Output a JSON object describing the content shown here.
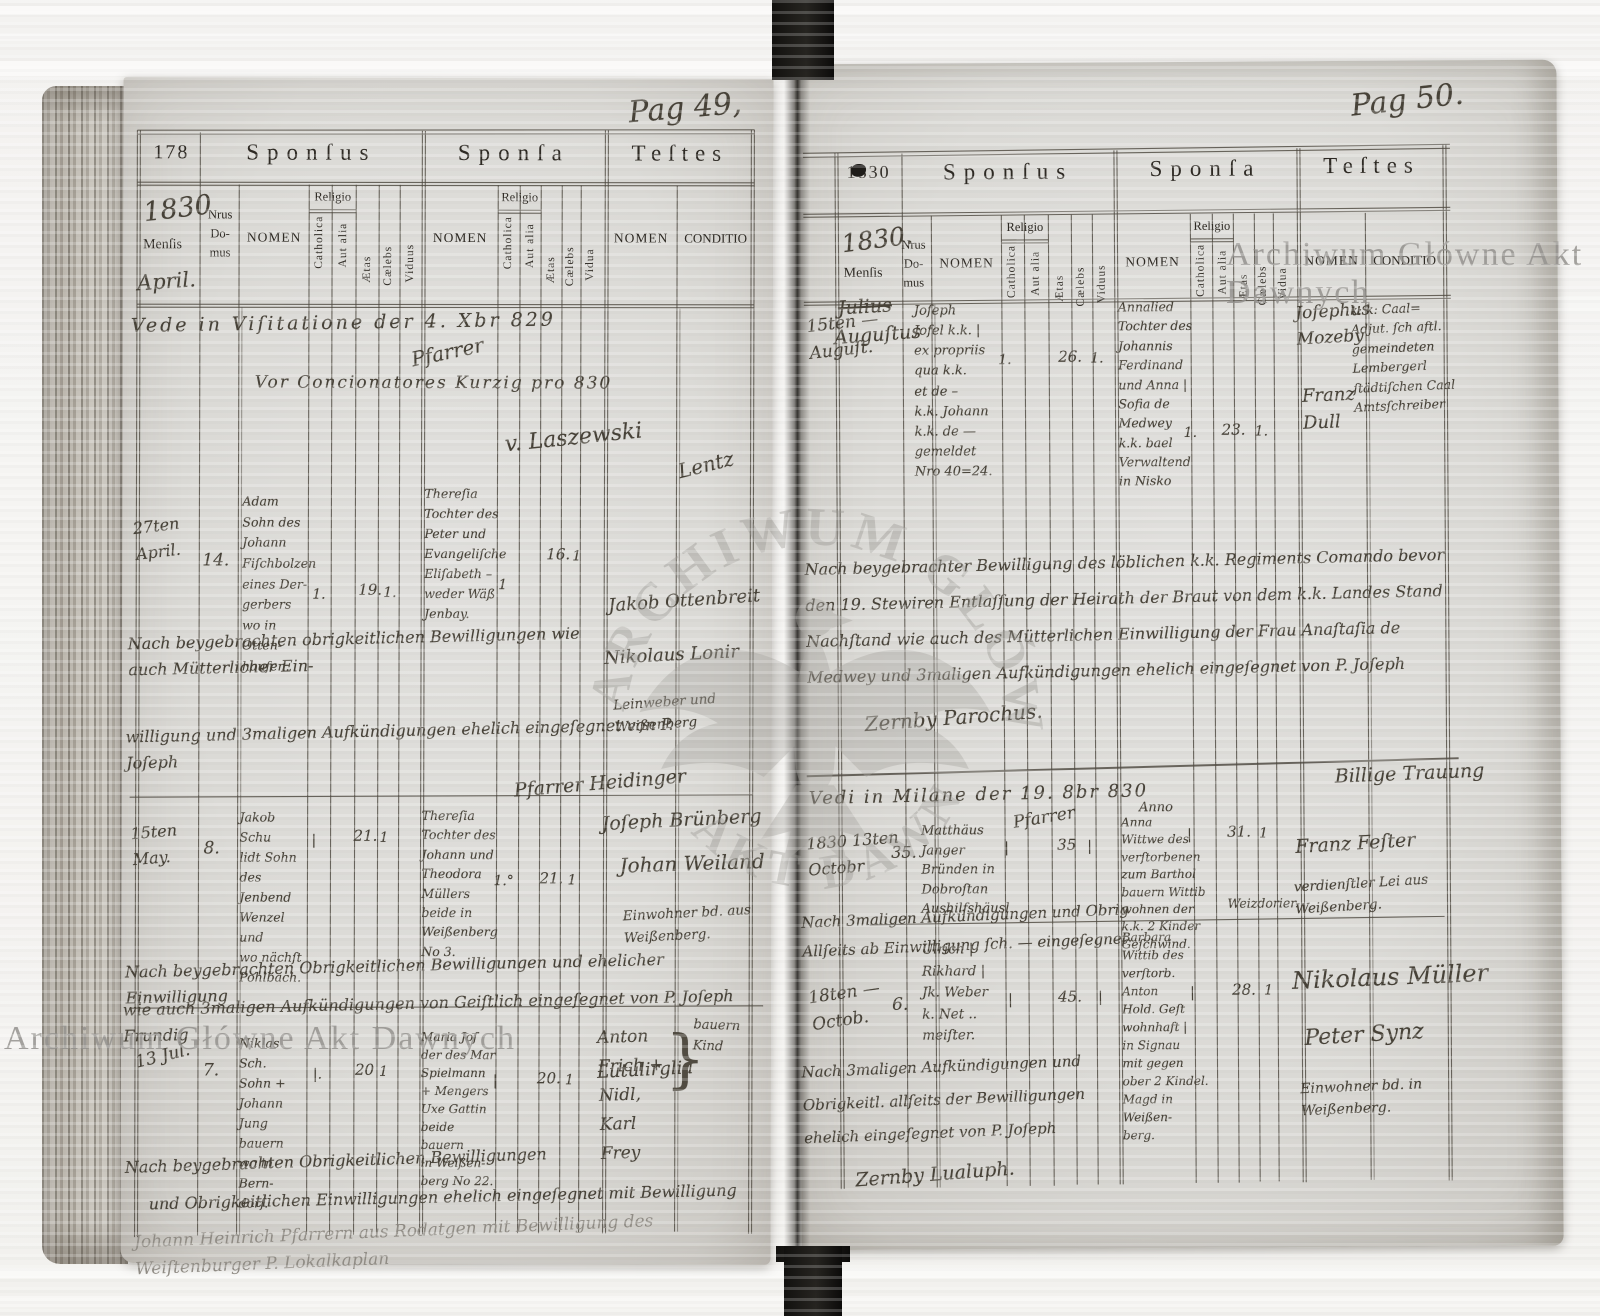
{
  "watermarks": {
    "stamp_left": "Archiwum Główne Akt Dawnych",
    "stamp_right": "Archiwum Główne Akt Dawnych",
    "seal_arc_top": "ARCHIWUM GŁÓWNE",
    "seal_arc_bottom": "AKT DAWNYCH"
  },
  "labels": {
    "sponsus": "Sponſus",
    "sponsa": "Sponſa",
    "testes": "Teſtes",
    "mensis": "Menſis",
    "nrus_domus": "Nrus\nDo-\nmus",
    "nomen": "NOMEN",
    "religio": "Religio",
    "catholica": "Catholica",
    "aut_alia": "Aut alia",
    "aetas": "Ætas",
    "caelebs": "Cælebs",
    "viduus": "Viduus",
    "vidua": "Vidua",
    "conditio": "CONDITIO"
  },
  "left_page": {
    "page_number": "Pag 49,",
    "folio": "178",
    "year": "1830",
    "month": "April.",
    "visitation": {
      "line1": "Vede in Viſitatione der 4. Xbr 829",
      "sig": "Pfarrer",
      "line2": "Vor Concionatores Kurzig pro 830",
      "line3": "v. Laszewski",
      "flourish": "Lentz"
    },
    "entries": [
      {
        "date": "27ten\nApril.",
        "nr": "14.",
        "groom": "Adam\nSohn des\nJohann\nFiſchbolzen\neines Der-\ngerbers\nwo in Otten-\nhauſen.",
        "groom_cath": "1.",
        "groom_aetas": "19.",
        "groom_cael": "1.",
        "bride": "Thereſia\nTochter des\nPeter und\nEvangeliſche\nEliſabeth –\nweder Wäß\nJenbay.",
        "bride_cath": "1",
        "bride_aetas": "16.",
        "bride_cael": "1",
        "witness1": "Jakob Ottenbreit",
        "witness2": "Nikolaus Lonir",
        "witness_note": "Leinweber und\nWeißenberg",
        "note1": "Nach beygebrachten obrigkeitlichen Bewilligungen wie auch Mütterlicher Ein-",
        "note2": "willigung und 3maligen Aufkündigungen ehelich eingeſegnet von P. Joſeph",
        "note_sig": "Pfarrer Heidinger"
      },
      {
        "date": "15ten\nMay.",
        "nr": "8.",
        "groom": "Jakob Schu\nlidt Sohn des\nJenbend\nWenzel und\nwo nächſt\nPohlbach.",
        "groom_cath": "|",
        "groom_aetas": "21.",
        "groom_cael": "1",
        "bride": "Thereſia\nTochter des\nJohann und\nTheodora\nMüllers\nbeide in\nWeißenberg No 3.",
        "bride_cath": "1.°",
        "bride_aetas": "21.",
        "bride_cael": "1",
        "witness1": "Joſeph Brünberg",
        "witness2": "Johan Weiland",
        "witness_note": "Einwohner bd. aus\nWeißenberg.",
        "note1": "Nach beygebrachten Obrigkeitlichen Bewilligungen und ehelicher Einwilligung",
        "note2": "wie auch 3maligen Aufkündigungen von Geiſtlich eingeſegnet von P. Joſeph Frundig",
        "note_sig": "Lutulirglia"
      },
      {
        "date": "13 Jul.",
        "nr": "7.",
        "groom": "Niklas Sch.\nSohn + Johann\nJung bauern\nwo in Bern-\ndorf.",
        "groom_cath": "|.",
        "groom_aetas": "20",
        "groom_cael": "1",
        "bride": "Maria Joſ\nder des Mar\nSpielmann\n+ Mengers\nUxe Gattin\nbeide bauern\nin Weißen-\nberg No 22.",
        "bride_cath": "|",
        "bride_aetas": "20.",
        "bride_cael": "1",
        "witness1": "Anton\nFrich +\nNidl,\nKarl\nFrey",
        "brace": "}",
        "witness_note": "bauern Kind",
        "note1": "Nach beygebrachten Obrigkeitlichen Bewilligungen",
        "note2": "und Obrigkeitlichen Einwilligungen ehelich eingeſegnet mit Bewilligung",
        "note_sig": ""
      }
    ],
    "pencil_note": "Johann Heinrich Pfarrern aus Rodatgen mit Bewilligung des\nWeiſtenburger P. Lokalkaplan"
  },
  "right_page": {
    "page_number": "Pag 50.",
    "folio": "1830",
    "year": "1830.",
    "month_cancelled": "Julius",
    "month": "Auguſtus",
    "entries": [
      {
        "date": "15ten —\nAuguſt.",
        "nr": "",
        "groom": "Joſeph\nJofel k.k. |\nex propriis\nqua k.k.\net de –\nk.k. Johann\nk.k. de —\ngemeldet\nNro 40=24.",
        "groom_cath": "1.",
        "groom_aetas": "26.",
        "groom_cael": "1.",
        "bride": "Annalied\nTochter des\nJohannis\nFerdinand\nund Anna |\nSofia de\nMedwey\nk.k. bael\nVerwaltend\nin Nisko",
        "bride_cath": "1.",
        "bride_aetas": "23.",
        "bride_cael": "1.",
        "witness1": "Joſephus\nMozeby",
        "witness2": "Franz\nDull",
        "conditio": "k: k: Caal=\nAdjut. ſch aftl.\ngemeindeten\nLembergerl\nſtädtiſchen Caal\nAmtsſchreiber",
        "note": "Nach beygebrachter Bewilligung des löblichen k.k. Regiments Comando bevor\nden 19. Stewiren Entlaſſung der Heirath der Braut von dem k.k. Landes Stand\nNachſtand wie auch des Mütterlichen Einwilligung der Frau Anaſtaſia de\nMedwey und 3maligen Aufkündigungen ehelich eingeſegnet von P. Joſeph",
        "note_sig": "Zernby Parochus."
      },
      {
        "date": "1830 13ten\nOctobr",
        "nr": "35.",
        "groom": "Matthäus\nJanger\nBründen in\nDobroſtan\nAushilfshäusl",
        "groom_cath": "|",
        "groom_aetas": "35",
        "groom_cael": "|",
        "bride": "Anna\nWittwe des\nverſtorbenen\nzum Barthol\nbauern Wittib\nwohnen der\nk.k. 2 Kinder\nGeſchwind.",
        "bride_extra": "Weizdorier.",
        "bride_cath": "|",
        "bride_aetas": "31.",
        "bride_cael": "1",
        "witness1": "Franz Feſter",
        "witness_note": "verdienſtler Lei aus\nWeißenberg.",
        "note": "Nach 3maligen Aufkündigungen und Obrig\nAllſeits ab Einwilligung ſch. — eingeſegnet"
      },
      {
        "date": "18ten —\nOctob.",
        "nr": "6.",
        "groom": "Ulrich |\nRikhard |\nJk. Weber\nk. Net ..\nmeiſter.",
        "groom_cath": "|",
        "groom_aetas": "45.",
        "groom_vid": "|",
        "bride": "Barbara\nWittib des\nverſtorb. Anton\nHold. Geſt\nwohnhaft |\nin Signau\nmit gegen\nober 2 Kindel.\nMagd in\nWeißen-\nberg.",
        "bride_cath": "|",
        "bride_aetas": "28.",
        "bride_cael": "1",
        "witness1": "Nikolaus Müller",
        "witness2": "Peter Synz",
        "witness_note": "Einwohner bd. in\nWeißenberg.",
        "note": "Nach 3maligen Aufkündigungen und\nObrigkeitl. allſeits der Bewilligungen\nehelich eingeſegnet von P. Joſeph",
        "note_sig": "Zernby Lualuph."
      }
    ],
    "vedi_note": "Vedi in Milane der 19. 8br 830",
    "vedi_sig": "Pfarrer",
    "vedi_small": "Anno",
    "billige": "Billige Trauung"
  }
}
